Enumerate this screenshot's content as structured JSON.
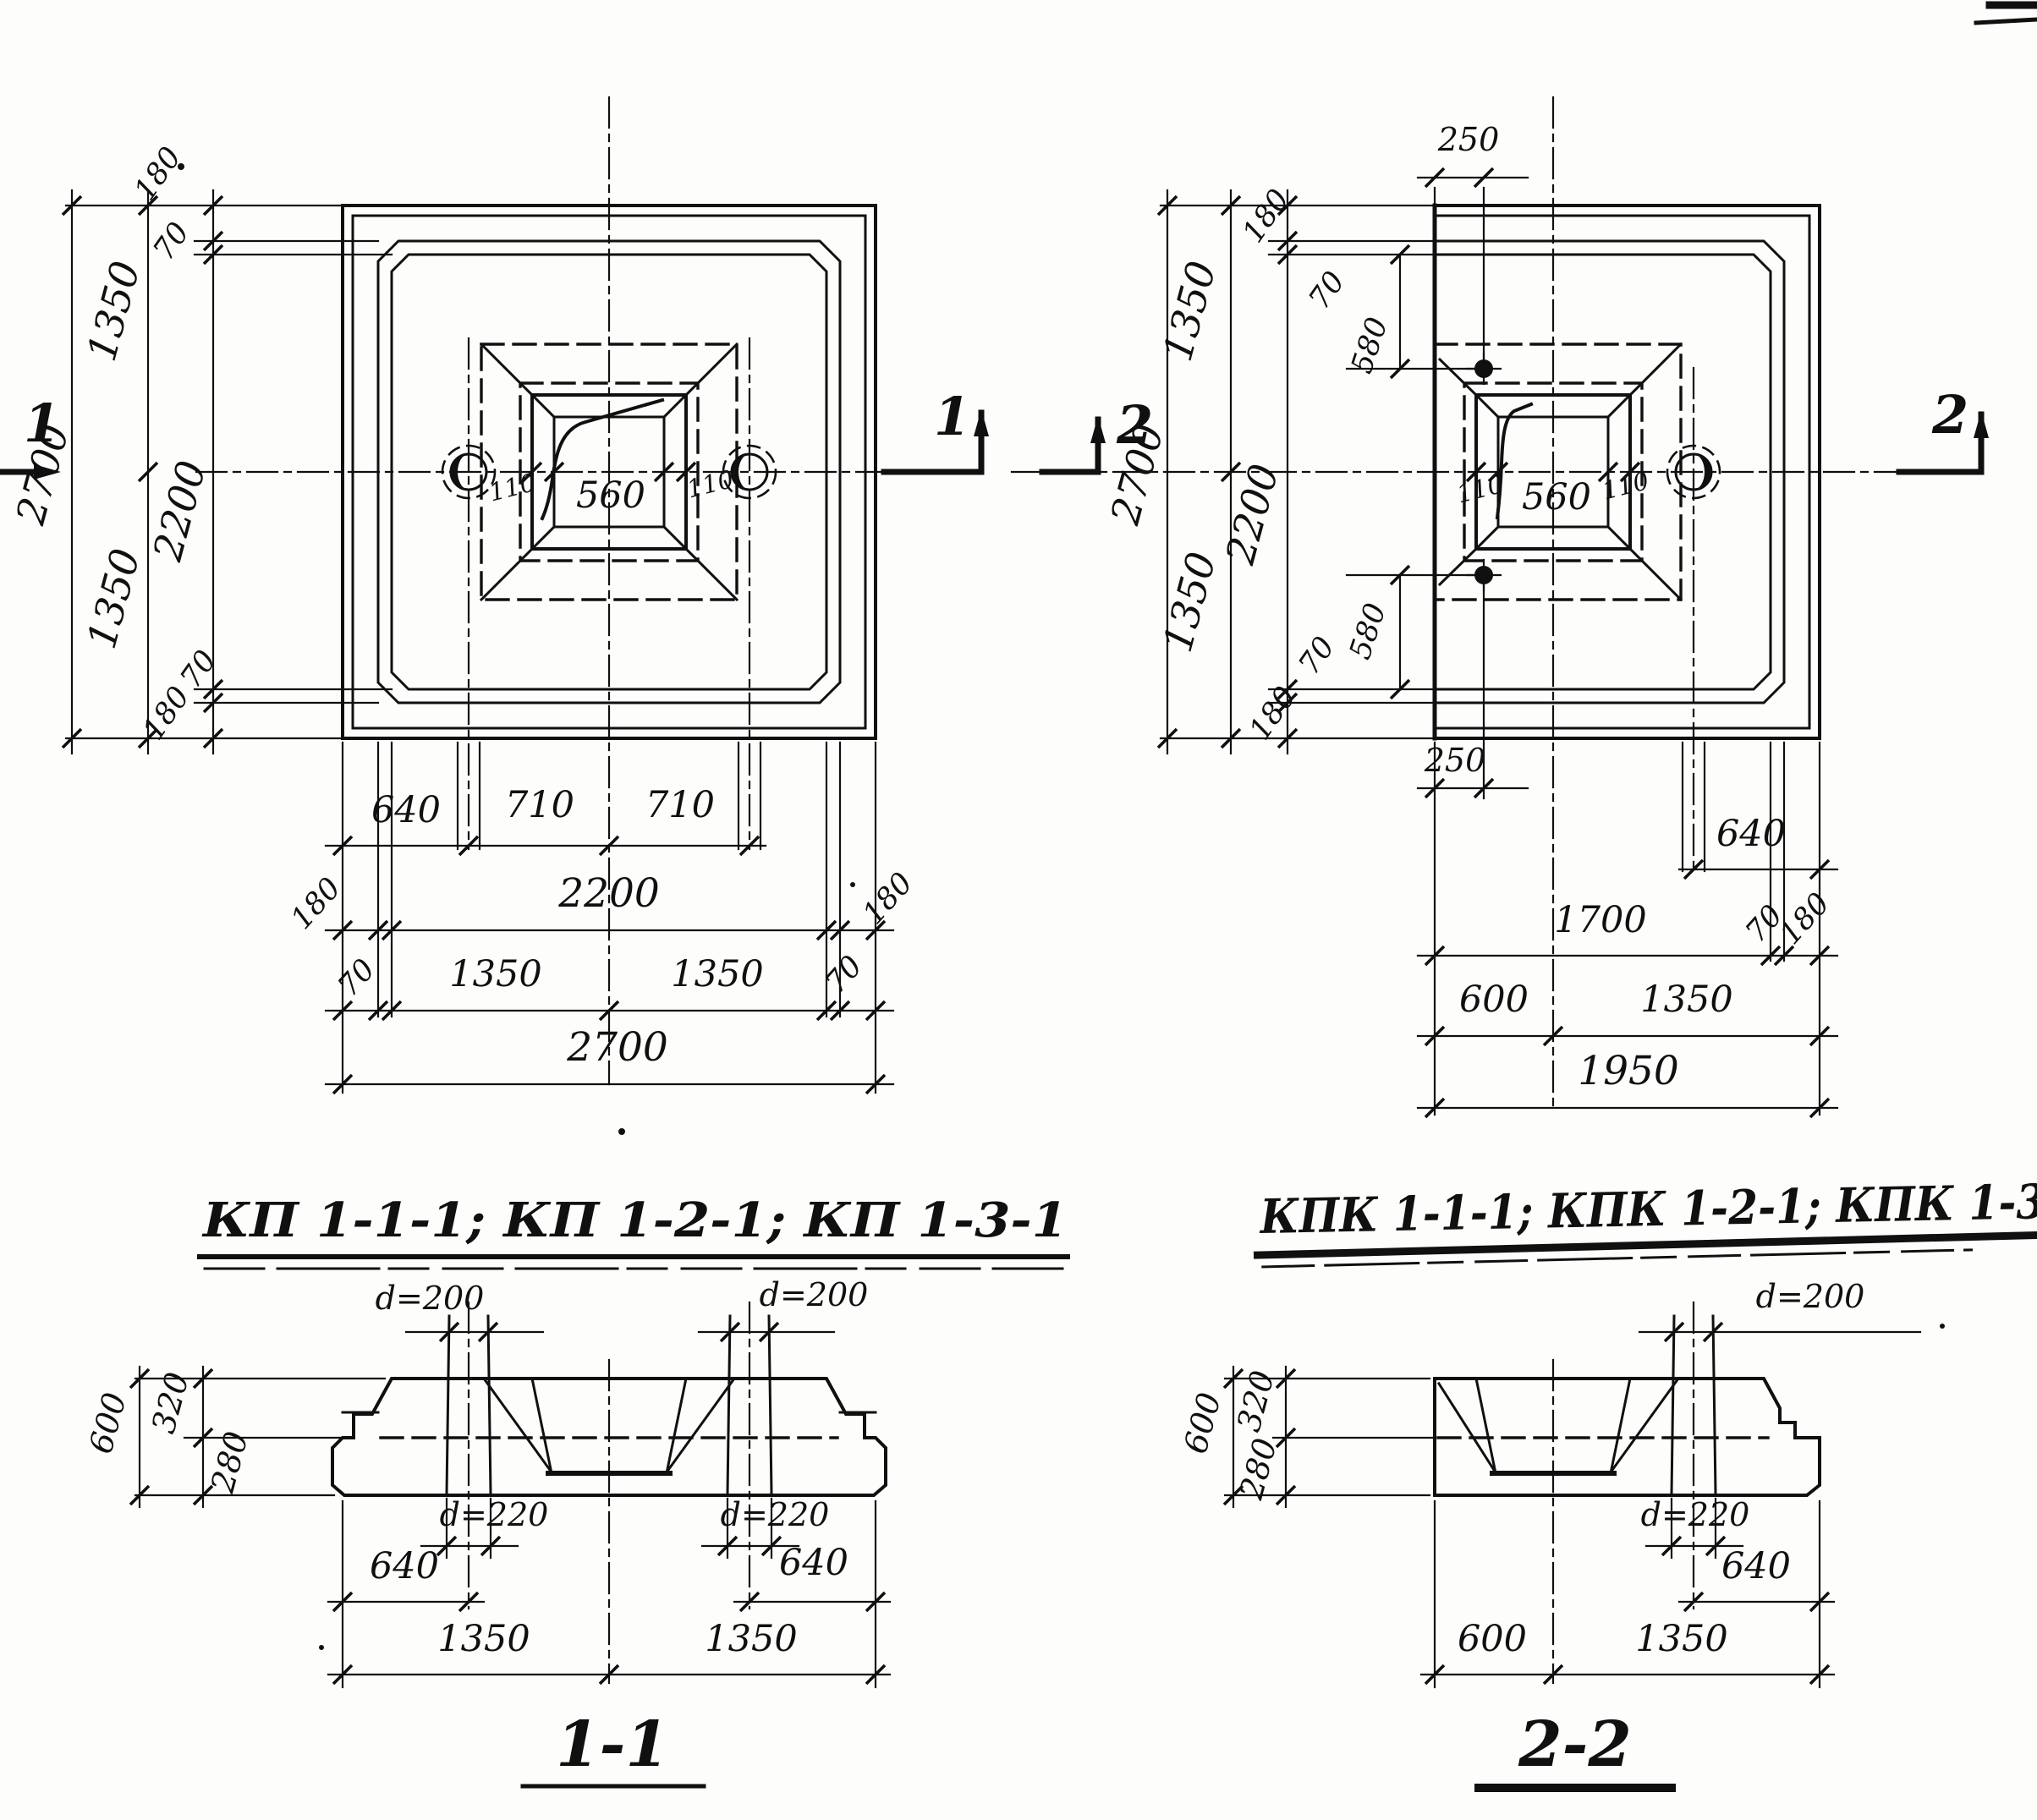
{
  "plan_left": {
    "title": "КП 1-1-1; КП 1-2-1; КП 1-3-1",
    "section_label": "1",
    "socket_dims": {
      "left": "110",
      "center": "560",
      "right": "110"
    },
    "left_chain": {
      "d180_top": "180",
      "d70_top": "70",
      "d1350_top": "1350",
      "d2700": "2700",
      "d2200": "2200",
      "d1350_bot": "1350",
      "d70_bot": "70",
      "d180_bot": "180"
    },
    "bottom_rows": {
      "row1": [
        "640",
        "710",
        "710"
      ],
      "row2": [
        "180",
        "2200",
        "180"
      ],
      "row3": [
        "70",
        "1350",
        "1350",
        "70"
      ],
      "total": "2700"
    }
  },
  "plan_right": {
    "title": "КПК 1-1-1; КПК 1-2-1; КПК 1-3-1",
    "section_label": "2",
    "socket_dims": {
      "left": "110",
      "center": "560",
      "right": "110"
    },
    "hole_offset_top": "250",
    "hole_offset_bottom": "250",
    "left_chain": {
      "d1350_top": "1350",
      "d2700": "2700",
      "d2200": "2200",
      "d1350_bot": "1350"
    },
    "diag_top": [
      "180",
      "70",
      "580"
    ],
    "diag_bottom": [
      "70",
      "580",
      "180"
    ],
    "bottom_rows": {
      "row1": [
        "640"
      ],
      "row2": [
        "1700",
        "70",
        "180"
      ],
      "row3": [
        "600",
        "1350"
      ],
      "total": "1950"
    }
  },
  "section_1_1": {
    "title": "1-1",
    "top_sleeve_dia": "d=200",
    "bottom_sleeve_dia": "d=220",
    "heights": {
      "total": "600",
      "upper": "320",
      "lower": "280"
    },
    "bottom_rows": {
      "offset_left": "640",
      "offset_right": "640",
      "half_left": "1350",
      "half_right": "1350"
    }
  },
  "section_2_2": {
    "title": "2-2",
    "top_sleeve_dia": "d=200",
    "bottom_sleeve_dia": "d=220",
    "heights": {
      "total": "600",
      "upper": "320",
      "lower": "280"
    },
    "bottom_rows": {
      "offset_right": "640",
      "left": "600",
      "right": "1350"
    }
  }
}
